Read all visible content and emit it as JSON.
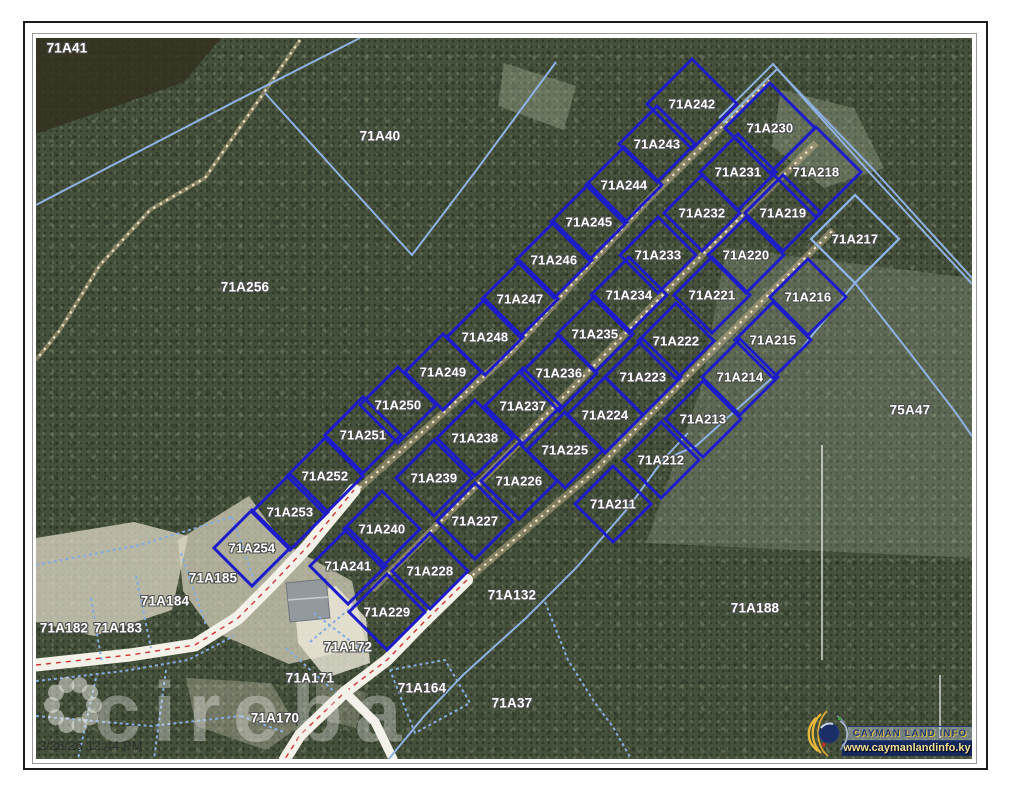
{
  "frame": {
    "timestamp": "3/26/26 12:44 PM"
  },
  "watermark": {
    "text": "cireba"
  },
  "branding": {
    "title": "CAYMAN LAND INFO",
    "url": "www.caymanlandinfo.ky"
  },
  "colors": {
    "subdivision_boundary": "#1e1cc8",
    "cadastral_boundary": "#8fb2e4",
    "road_centerline": "#cf3333",
    "road_surface": "#f4f1e8",
    "trail": "#c4b28c",
    "banner_bg": "#16295c",
    "label_text": "#ffffff"
  },
  "parcels": {
    "subdivision_rows": [
      {
        "name": "northwest",
        "items": [
          {
            "id": "71A242",
            "x": 656,
            "y": 66
          },
          {
            "id": "71A243",
            "x": 621,
            "y": 106
          },
          {
            "id": "71A244",
            "x": 588,
            "y": 147
          },
          {
            "id": "71A245",
            "x": 553,
            "y": 184
          },
          {
            "id": "71A246",
            "x": 518,
            "y": 222
          },
          {
            "id": "71A247",
            "x": 484,
            "y": 261
          },
          {
            "id": "71A248",
            "x": 449,
            "y": 299
          },
          {
            "id": "71A249",
            "x": 407,
            "y": 334
          },
          {
            "id": "71A250",
            "x": 362,
            "y": 367
          },
          {
            "id": "71A251",
            "x": 327,
            "y": 397
          },
          {
            "id": "71A252",
            "x": 289,
            "y": 438
          },
          {
            "id": "71A253",
            "x": 254,
            "y": 474
          },
          {
            "id": "71A254",
            "x": 216,
            "y": 510
          }
        ]
      },
      {
        "name": "middle",
        "items": [
          {
            "id": "71A230",
            "x": 734,
            "y": 90
          },
          {
            "id": "71A231",
            "x": 702,
            "y": 134
          },
          {
            "id": "71A232",
            "x": 666,
            "y": 175
          },
          {
            "id": "71A233",
            "x": 622,
            "y": 217
          },
          {
            "id": "71A234",
            "x": 593,
            "y": 257
          },
          {
            "id": "71A235",
            "x": 559,
            "y": 296
          },
          {
            "id": "71A236",
            "x": 523,
            "y": 335
          },
          {
            "id": "71A237",
            "x": 487,
            "y": 368
          },
          {
            "id": "71A238",
            "x": 439,
            "y": 400
          },
          {
            "id": "71A239",
            "x": 398,
            "y": 440
          },
          {
            "id": "71A240",
            "x": 346,
            "y": 491
          },
          {
            "id": "71A241",
            "x": 312,
            "y": 528
          }
        ]
      },
      {
        "name": "southeast",
        "items": [
          {
            "id": "71A218",
            "x": 780,
            "y": 134
          },
          {
            "id": "71A219",
            "x": 747,
            "y": 175
          },
          {
            "id": "71A220",
            "x": 710,
            "y": 217
          },
          {
            "id": "71A221",
            "x": 676,
            "y": 257
          },
          {
            "id": "71A222",
            "x": 640,
            "y": 303
          },
          {
            "id": "71A223",
            "x": 607,
            "y": 339
          },
          {
            "id": "71A224",
            "x": 569,
            "y": 377
          },
          {
            "id": "71A225",
            "x": 529,
            "y": 412
          },
          {
            "id": "71A226",
            "x": 483,
            "y": 443
          },
          {
            "id": "71A227",
            "x": 439,
            "y": 483
          },
          {
            "id": "71A228",
            "x": 394,
            "y": 533
          },
          {
            "id": "71A229",
            "x": 351,
            "y": 574
          }
        ]
      },
      {
        "name": "outer",
        "items": [
          {
            "id": "71A216",
            "x": 772,
            "y": 259
          },
          {
            "id": "71A215",
            "x": 737,
            "y": 302
          },
          {
            "id": "71A214",
            "x": 704,
            "y": 339
          },
          {
            "id": "71A213",
            "x": 667,
            "y": 381
          },
          {
            "id": "71A212",
            "x": 625,
            "y": 422
          },
          {
            "id": "71A211",
            "x": 577,
            "y": 466
          }
        ]
      }
    ],
    "light_parcel": {
      "id": "71A217",
      "x": 819,
      "y": 201
    },
    "area_labels": [
      {
        "id": "71A41",
        "x": 31,
        "y": 10
      },
      {
        "id": "71A40",
        "x": 344,
        "y": 98
      },
      {
        "id": "71A256",
        "x": 209,
        "y": 249
      },
      {
        "id": "75A47",
        "x": 874,
        "y": 372
      },
      {
        "id": "71A188",
        "x": 719,
        "y": 570
      },
      {
        "id": "71A132",
        "x": 476,
        "y": 557
      },
      {
        "id": "71A185",
        "x": 177,
        "y": 540
      },
      {
        "id": "71A184",
        "x": 129,
        "y": 563
      },
      {
        "id": "71A183",
        "x": 82,
        "y": 590
      },
      {
        "id": "71A182",
        "x": 28,
        "y": 590
      },
      {
        "id": "71A172",
        "x": 312,
        "y": 609
      },
      {
        "id": "71A171",
        "x": 274,
        "y": 640
      },
      {
        "id": "71A170",
        "x": 239,
        "y": 680
      },
      {
        "id": "71A164",
        "x": 386,
        "y": 650
      },
      {
        "id": "71A37",
        "x": 476,
        "y": 665
      }
    ]
  }
}
